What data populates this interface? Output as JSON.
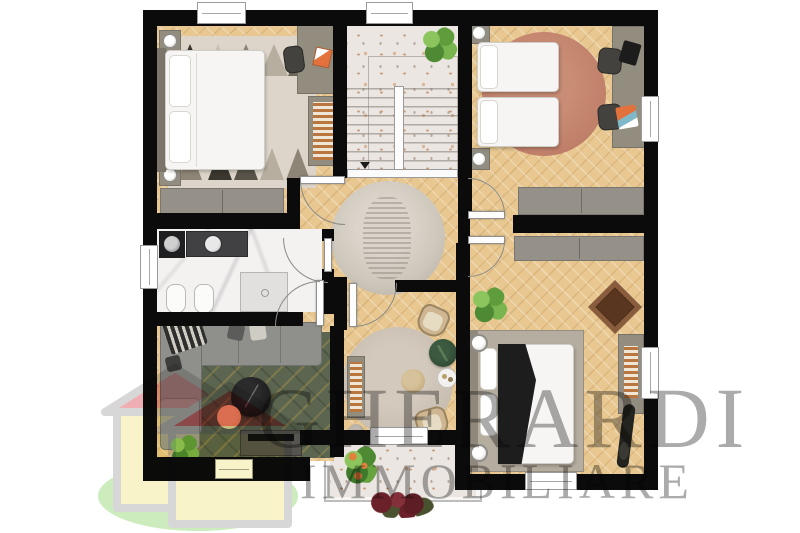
{
  "watermark": {
    "line1": "GHERARDI",
    "line2": "IMMOBILIARE",
    "text_color": "#ababab"
  },
  "logo": {
    "roof_back": "#ea9aa0",
    "roof_front": "#e0565c",
    "body_fill": "#f8f0bc",
    "outline": "#cdcdcd",
    "ground_ellipse": "#bfe7ae"
  },
  "palette": {
    "wall": "#0b0b0b",
    "wood_floor": "#e8c890",
    "terrazzo": "#ebe6e1",
    "marble": "#f4f2f0",
    "rug_green": "#5b6550",
    "rug_terracotta": "#c0806a",
    "rug_hall": "#cdc6bb",
    "rug_nook": "#c8beb1",
    "furniture_gray": "#938d80",
    "bed_white": "#f6f5f3",
    "accent_orange": "#e2713c",
    "pouf_yellow": "#ead98a",
    "wood_brown": "#6f4530",
    "wm_text": "#ababab"
  }
}
